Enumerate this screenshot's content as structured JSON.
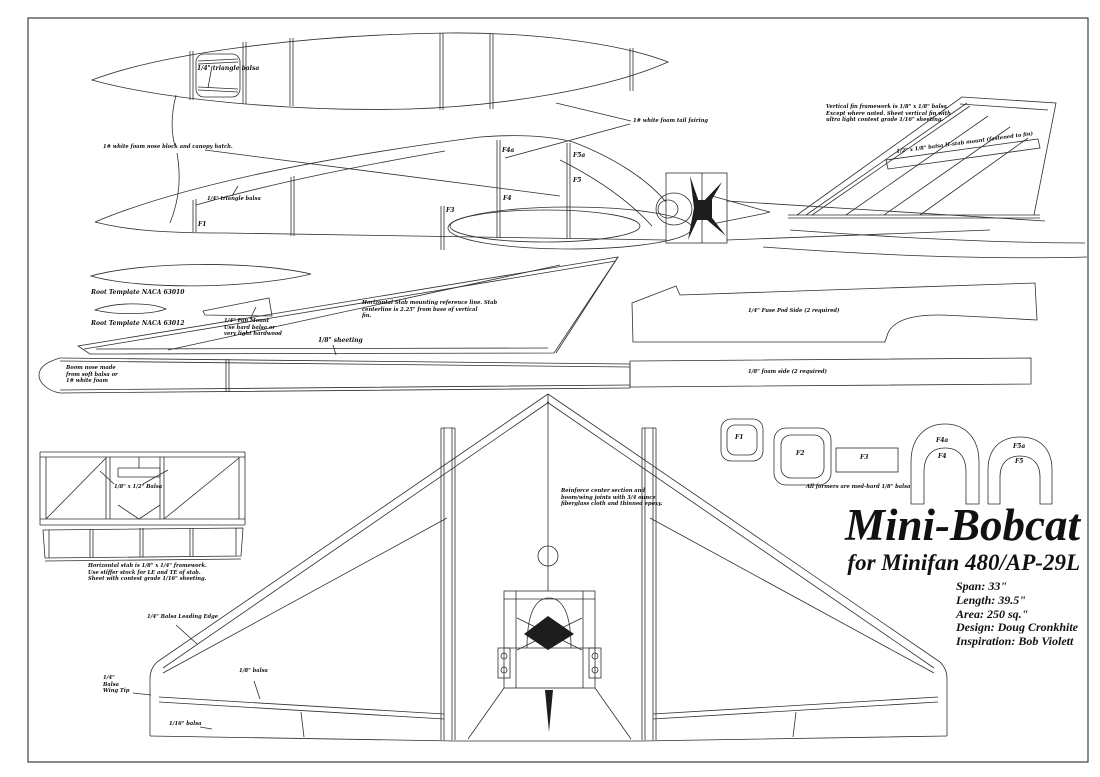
{
  "sheet": {
    "background": "#ffffff",
    "line_color": "#2e2e2e",
    "text_color": "#111111"
  },
  "title_block": {
    "title": "Mini-Bobcat",
    "subtitle": "for Minifan 480/AP-29L",
    "specs": {
      "span": "Span: 33\"",
      "length": "Length: 39.5\"",
      "area": "Area: 250 sq.\"",
      "design": "Design: Doug Cronkhite",
      "inspiration": "Inspiration: Bob Violett"
    }
  },
  "labels": {
    "triangle_balsa_top": "1/4\" triangle balsa",
    "triangle_balsa_side": "1/4\" triangle balsa",
    "nose_block": "1# white foam nose block and canopy hatch.",
    "tail_fairing": "1# white foam tail fairing",
    "fin_framework": "Vertical fin framework is 1/8\" x 1/8\" balsa.\nExcept where noted. Sheet vertical fin with\nultra light contest grade 1/16\" sheeting.",
    "hstab_mount": "1/2\" x 1/8\" balsa H-stab mount (fastened to fin)",
    "root_template_top": "Root Template NACA 63010",
    "root_template_bottom": "Root Template NACA 63012",
    "fan_mount": "1/4\" Fan Mount\nUse hard balsa or\nvery light hardwood",
    "stab_reference": "Horizontal Stab mounting reference line. Stab\ncenterline is 2.25\" from base of vertical\nfin.",
    "sheeting": "1/8\" sheeting",
    "fuse_pod_side": "1/4\" Fuse Pod Side (2 required)",
    "foam_side": "1/8\" foam side (2 required)",
    "boom_nose": "Boom nose made\nfrom soft balsa or\n1# white foam",
    "stab_balsa": "1/8\" x 1/2\" Balsa",
    "stab_framework": "Horizontal stab is 1/8\" x 1/4\" framework.\nUse stiffer stock for LE and TE of stab.\nSheet with contest grade 1/16\" sheeting.",
    "reinforce": "Reinforce center section and\nboom/wing joints with 3/4 ounce\nfiberglass cloth and thinned epoxy.",
    "leading_edge": "1/4\" Balsa Leading Edge",
    "wing_tip": "1/4\"\nBalsa\nWing Tip",
    "balsa_18": "1/8\" balsa",
    "balsa_116": "1/16\" balsa",
    "formers_note": "All formers are med-hard 1/8\" balsa"
  },
  "formers": {
    "f1": "F1",
    "f2": "F2",
    "f3": "F3",
    "f4": "F4",
    "f4a": "F4a",
    "f5": "F5",
    "f5a": "F5a"
  }
}
